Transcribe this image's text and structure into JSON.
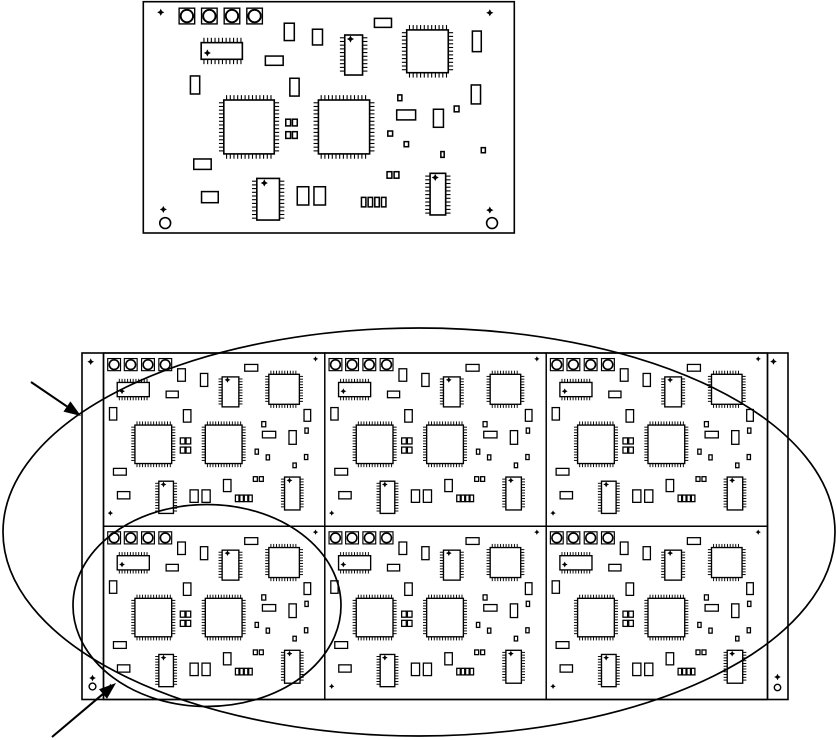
{
  "figure": {
    "width": 836,
    "height": 740,
    "background_color": "#ffffff",
    "ink_color": "#000000",
    "description": "PCB panelization drawing: single circuit board assembly on top, 2x3 panelized array with side rails below, annotated with two callout ellipses and two leader arrows"
  },
  "single_board": {
    "x": 143.3,
    "y": 1.7,
    "w": 371,
    "h": 231.3,
    "layout": "large"
  },
  "panel": {
    "x": 82,
    "y": 353,
    "w": 706,
    "h": 346.5,
    "rail_inner_left_x": 103.5,
    "rail_inner_right_x": 767.5,
    "rows": 2,
    "cols": 3,
    "board_layout": "small",
    "rail_marks": [
      {
        "t": "diamond",
        "x": 90.7,
        "y": 361.7
      },
      {
        "t": "diamond",
        "x": 773.5,
        "y": 361.5
      },
      {
        "t": "diamond",
        "x": 92.5,
        "y": 678.0
      },
      {
        "t": "circle",
        "x": 92.5,
        "y": 686.5,
        "r": 3.4
      },
      {
        "t": "diamond",
        "x": 777.5,
        "y": 677.0
      },
      {
        "t": "circle",
        "x": 777.5,
        "y": 687.5,
        "r": 3.2
      }
    ]
  },
  "board_layouts": {
    "large": {
      "fiducials": [
        {
          "t": "diamond",
          "x": 0.047,
          "y": 0.046
        },
        {
          "t": "diamond",
          "x": 0.934,
          "y": 0.048
        },
        {
          "t": "diamond",
          "x": 0.054,
          "y": 0.898
        },
        {
          "t": "circle",
          "x": 0.059,
          "y": 0.957
        },
        {
          "t": "diamond",
          "x": 0.934,
          "y": 0.901
        },
        {
          "t": "circle",
          "x": 0.94,
          "y": 0.957
        }
      ],
      "components": [
        {
          "t": "pad",
          "x": 0.0965,
          "y": 0.028,
          "w": 0.042,
          "h": 0.068
        },
        {
          "t": "pad",
          "x": 0.157,
          "y": 0.028,
          "w": 0.042,
          "h": 0.068
        },
        {
          "t": "pad",
          "x": 0.218,
          "y": 0.028,
          "w": 0.042,
          "h": 0.068
        },
        {
          "t": "pad",
          "x": 0.279,
          "y": 0.028,
          "w": 0.042,
          "h": 0.068
        },
        {
          "t": "soich",
          "x": 0.156,
          "y": 0.177,
          "w": 0.111,
          "h": 0.072,
          "dot": [
            0.15,
            0.62
          ]
        },
        {
          "t": "rect",
          "x": 0.38,
          "y": 0.093,
          "w": 0.027,
          "h": 0.075
        },
        {
          "t": "rect",
          "x": 0.456,
          "y": 0.119,
          "w": 0.027,
          "h": 0.068
        },
        {
          "t": "soicv",
          "x": 0.543,
          "y": 0.144,
          "w": 0.048,
          "h": 0.173,
          "dot": [
            0.32,
            0.1
          ]
        },
        {
          "t": "qfp",
          "x": 0.71,
          "y": 0.122,
          "w": 0.112,
          "h": 0.185
        },
        {
          "t": "rect",
          "x": 0.623,
          "y": 0.072,
          "w": 0.046,
          "h": 0.039
        },
        {
          "t": "rect",
          "x": 0.887,
          "y": 0.127,
          "w": 0.024,
          "h": 0.089
        },
        {
          "t": "rect",
          "x": 0.127,
          "y": 0.321,
          "w": 0.025,
          "h": 0.078
        },
        {
          "t": "rect",
          "x": 0.329,
          "y": 0.235,
          "w": 0.048,
          "h": 0.04
        },
        {
          "t": "rect",
          "x": 0.395,
          "y": 0.331,
          "w": 0.025,
          "h": 0.077
        },
        {
          "t": "qfp",
          "x": 0.217,
          "y": 0.425,
          "w": 0.136,
          "h": 0.233
        },
        {
          "t": "qfp",
          "x": 0.472,
          "y": 0.425,
          "w": 0.138,
          "h": 0.233
        },
        {
          "t": "rect",
          "x": 0.384,
          "y": 0.508,
          "w": 0.013,
          "h": 0.029
        },
        {
          "t": "rect",
          "x": 0.402,
          "y": 0.508,
          "w": 0.013,
          "h": 0.029
        },
        {
          "t": "rect",
          "x": 0.384,
          "y": 0.562,
          "w": 0.013,
          "h": 0.029
        },
        {
          "t": "rect",
          "x": 0.402,
          "y": 0.562,
          "w": 0.013,
          "h": 0.029
        },
        {
          "t": "rect",
          "x": 0.686,
          "y": 0.403,
          "w": 0.011,
          "h": 0.025
        },
        {
          "t": "rect",
          "x": 0.683,
          "y": 0.468,
          "w": 0.051,
          "h": 0.043
        },
        {
          "t": "rect",
          "x": 0.782,
          "y": 0.465,
          "w": 0.027,
          "h": 0.078
        },
        {
          "t": "rect",
          "x": 0.838,
          "y": 0.451,
          "w": 0.013,
          "h": 0.025
        },
        {
          "t": "rect",
          "x": 0.659,
          "y": 0.559,
          "w": 0.013,
          "h": 0.022
        },
        {
          "t": "rect",
          "x": 0.703,
          "y": 0.605,
          "w": 0.012,
          "h": 0.022
        },
        {
          "t": "rect",
          "x": 0.802,
          "y": 0.648,
          "w": 0.009,
          "h": 0.025
        },
        {
          "t": "rect",
          "x": 0.911,
          "y": 0.631,
          "w": 0.011,
          "h": 0.022
        },
        {
          "t": "rect",
          "x": 0.884,
          "y": 0.36,
          "w": 0.025,
          "h": 0.082
        },
        {
          "t": "rect",
          "x": 0.136,
          "y": 0.68,
          "w": 0.047,
          "h": 0.045
        },
        {
          "t": "rect",
          "x": 0.157,
          "y": 0.821,
          "w": 0.045,
          "h": 0.048
        },
        {
          "t": "soicv",
          "x": 0.306,
          "y": 0.764,
          "w": 0.061,
          "h": 0.18,
          "dot": [
            0.33,
            0.11
          ]
        },
        {
          "t": "rect",
          "x": 0.415,
          "y": 0.8,
          "w": 0.031,
          "h": 0.079
        },
        {
          "t": "rect",
          "x": 0.46,
          "y": 0.8,
          "w": 0.031,
          "h": 0.079
        },
        {
          "t": "rect",
          "x": 0.657,
          "y": 0.735,
          "w": 0.013,
          "h": 0.028
        },
        {
          "t": "rect",
          "x": 0.676,
          "y": 0.735,
          "w": 0.013,
          "h": 0.028
        },
        {
          "t": "rect",
          "x": 0.588,
          "y": 0.846,
          "w": 0.012,
          "h": 0.041
        },
        {
          "t": "rect",
          "x": 0.606,
          "y": 0.846,
          "w": 0.012,
          "h": 0.041
        },
        {
          "t": "rect",
          "x": 0.624,
          "y": 0.846,
          "w": 0.012,
          "h": 0.041
        },
        {
          "t": "rect",
          "x": 0.642,
          "y": 0.846,
          "w": 0.012,
          "h": 0.041
        },
        {
          "t": "soicv",
          "x": 0.773,
          "y": 0.742,
          "w": 0.042,
          "h": 0.18,
          "dot": [
            0.33,
            0.1
          ]
        }
      ]
    },
    "small": {
      "fiducials": [
        {
          "t": "diamond",
          "x": 0.958,
          "y": 0.034
        },
        {
          "t": "diamond",
          "x": 0.031,
          "y": 0.924
        }
      ],
      "components": [
        {
          "t": "pad",
          "x": 0.019,
          "y": 0.032,
          "w": 0.058,
          "h": 0.07
        },
        {
          "t": "pad",
          "x": 0.094,
          "y": 0.032,
          "w": 0.058,
          "h": 0.07
        },
        {
          "t": "pad",
          "x": 0.172,
          "y": 0.032,
          "w": 0.058,
          "h": 0.07
        },
        {
          "t": "pad",
          "x": 0.25,
          "y": 0.032,
          "w": 0.058,
          "h": 0.07
        },
        {
          "t": "rect",
          "x": 0.638,
          "y": 0.066,
          "w": 0.059,
          "h": 0.039
        },
        {
          "t": "rect",
          "x": 0.335,
          "y": 0.091,
          "w": 0.035,
          "h": 0.072
        },
        {
          "t": "rect",
          "x": 0.438,
          "y": 0.118,
          "w": 0.033,
          "h": 0.075
        },
        {
          "t": "soich",
          "x": 0.062,
          "y": 0.17,
          "w": 0.145,
          "h": 0.082,
          "dot": [
            0.15,
            0.62
          ]
        },
        {
          "t": "rect",
          "x": 0.283,
          "y": 0.22,
          "w": 0.055,
          "h": 0.038
        },
        {
          "t": "rect",
          "x": 0.027,
          "y": 0.315,
          "w": 0.033,
          "h": 0.072
        },
        {
          "t": "rect",
          "x": 0.361,
          "y": 0.327,
          "w": 0.034,
          "h": 0.072
        },
        {
          "t": "soicv",
          "x": 0.536,
          "y": 0.138,
          "w": 0.0755,
          "h": 0.173,
          "dot": [
            0.32,
            0.1
          ]
        },
        {
          "t": "qfp",
          "x": 0.747,
          "y": 0.123,
          "w": 0.138,
          "h": 0.173
        },
        {
          "t": "rect",
          "x": 0.906,
          "y": 0.326,
          "w": 0.03,
          "h": 0.068
        },
        {
          "t": "qfp",
          "x": 0.142,
          "y": 0.416,
          "w": 0.166,
          "h": 0.222
        },
        {
          "t": "qfp",
          "x": 0.46,
          "y": 0.416,
          "w": 0.166,
          "h": 0.222
        },
        {
          "t": "rect",
          "x": 0.347,
          "y": 0.49,
          "w": 0.021,
          "h": 0.035
        },
        {
          "t": "rect",
          "x": 0.373,
          "y": 0.49,
          "w": 0.021,
          "h": 0.035
        },
        {
          "t": "rect",
          "x": 0.347,
          "y": 0.543,
          "w": 0.021,
          "h": 0.035
        },
        {
          "t": "rect",
          "x": 0.373,
          "y": 0.543,
          "w": 0.021,
          "h": 0.035
        },
        {
          "t": "rect",
          "x": 0.715,
          "y": 0.396,
          "w": 0.018,
          "h": 0.03
        },
        {
          "t": "rect",
          "x": 0.718,
          "y": 0.452,
          "w": 0.06,
          "h": 0.038
        },
        {
          "t": "rect",
          "x": 0.838,
          "y": 0.448,
          "w": 0.033,
          "h": 0.079
        },
        {
          "t": "rect",
          "x": 0.91,
          "y": 0.433,
          "w": 0.015,
          "h": 0.03
        },
        {
          "t": "rect",
          "x": 0.685,
          "y": 0.555,
          "w": 0.015,
          "h": 0.029
        },
        {
          "t": "rect",
          "x": 0.735,
          "y": 0.588,
          "w": 0.015,
          "h": 0.029
        },
        {
          "t": "rect",
          "x": 0.856,
          "y": 0.635,
          "w": 0.015,
          "h": 0.027
        },
        {
          "t": "rect",
          "x": 0.908,
          "y": 0.586,
          "w": 0.015,
          "h": 0.029
        },
        {
          "t": "rect",
          "x": 0.045,
          "y": 0.666,
          "w": 0.058,
          "h": 0.039
        },
        {
          "t": "rect",
          "x": 0.063,
          "y": 0.8,
          "w": 0.056,
          "h": 0.042
        },
        {
          "t": "soicv",
          "x": 0.25,
          "y": 0.74,
          "w": 0.066,
          "h": 0.186,
          "dot": [
            0.32,
            0.1
          ]
        },
        {
          "t": "rect",
          "x": 0.391,
          "y": 0.79,
          "w": 0.037,
          "h": 0.072
        },
        {
          "t": "rect",
          "x": 0.445,
          "y": 0.79,
          "w": 0.037,
          "h": 0.072
        },
        {
          "t": "rect",
          "x": 0.542,
          "y": 0.73,
          "w": 0.034,
          "h": 0.07
        },
        {
          "t": "rect",
          "x": 0.677,
          "y": 0.714,
          "w": 0.018,
          "h": 0.027
        },
        {
          "t": "rect",
          "x": 0.704,
          "y": 0.714,
          "w": 0.018,
          "h": 0.027
        },
        {
          "t": "rect",
          "x": 0.596,
          "y": 0.82,
          "w": 0.016,
          "h": 0.038
        },
        {
          "t": "rect",
          "x": 0.616,
          "y": 0.82,
          "w": 0.016,
          "h": 0.038
        },
        {
          "t": "rect",
          "x": 0.636,
          "y": 0.82,
          "w": 0.016,
          "h": 0.038
        },
        {
          "t": "rect",
          "x": 0.656,
          "y": 0.82,
          "w": 0.016,
          "h": 0.038
        },
        {
          "t": "soicv",
          "x": 0.818,
          "y": 0.716,
          "w": 0.07,
          "h": 0.19,
          "dot": [
            0.32,
            0.1
          ]
        }
      ]
    }
  },
  "annotations": {
    "panel_callout_ellipse": {
      "cx": 419,
      "cy": 532,
      "rx": 416,
      "ry": 204
    },
    "board_callout_ellipse": {
      "cx": 207,
      "cy": 605.5,
      "rx": 134,
      "ry": 101
    },
    "arrows": [
      {
        "x1": 31,
        "y1": 382,
        "x2": 81,
        "y2": 416
      },
      {
        "x1": 52,
        "y1": 737,
        "x2": 116,
        "y2": 683
      }
    ]
  }
}
